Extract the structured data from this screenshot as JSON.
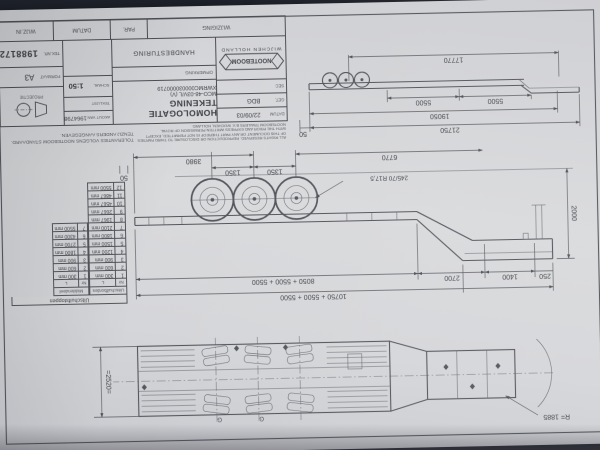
{
  "titleblock": {
    "company": "NOOTEBOOM",
    "location": "WIJCHEN  HOLLAND",
    "title": "HOMOLOGATIE TEKENING",
    "subtitle": "MCO-48-03V/L (V) XWRMC000030000719",
    "labels": {
      "datum": "DATUM",
      "get": "GET.",
      "sec": "SEC",
      "opmerking": "OPMERKING",
      "handbesturing": "HANDBESTURING",
      "akout": "AKOUT VAN",
      "teklijst": "TEKLIJST",
      "schaal": "SCHAAL",
      "projectie": "PROJECTIE",
      "formaat": "FORMAAT",
      "teknr": "TEK.NR.",
      "wijziging": "WIJZIGING",
      "par": "PAR.",
      "wijzin": "WIJZ.IN"
    },
    "values": {
      "datum": "22/09/03",
      "get": "BDG",
      "akout": "1964798",
      "schaal": "1:50",
      "formaat": "A3",
      "teknr": "1988172"
    },
    "tolerances_line1": "TOLERANTIES VOLGENS NOOTEBOOM STANDAARD.",
    "tolerances_line2": "TENZIJ ANDERS AANGEGEVEN.",
    "disclaimer": "ALL RIGHTS RESERVED. REPRODUCTION OR DISCLOSURE TO THIRD PARTIES OF THIS DOCUMENT OR ANY PART THEREOF IS NOT PERMITTED, EXCEPT WITH THE PRIOR AND EXPRESS WRITTEN PERMISSION OF ROYAL NOOTEBOOM TRAILERS B.V. WIJCHEN, HOLLAND."
  },
  "overview": {
    "d17770": "17770",
    "d5500a": "5500",
    "d5500b": "5500",
    "d19050": "19050",
    "d21750": "21750",
    "d50": "50"
  },
  "side": {
    "sum_top": "10750 + 5500 + 5500",
    "sum_mid": "8050 + 5500 + 5500",
    "d250": "250",
    "d1400": "1400",
    "d2700": "2700",
    "d6770": "6770",
    "d3980": "3980",
    "d1350a": "1350",
    "d1350b": "1350",
    "d50": "50",
    "d2000": "2000",
    "tyre": "245/70 R17,5"
  },
  "plan": {
    "width": "=2520=",
    "radius": "R= 1885",
    "g1": "G",
    "g2": "G"
  },
  "stop_table": {
    "title": "Uitschuifstoppen",
    "sub1": "Uitschuifbordes",
    "sub2": "Middendeel",
    "col_nr": "Nr",
    "col_l": "L",
    "bordes_rows": [
      [
        "1",
        "300 mm"
      ],
      [
        "2",
        "600 mm"
      ],
      [
        "3",
        "900 mm"
      ],
      [
        "4",
        "1200 mm"
      ],
      [
        "5",
        "1500 mm"
      ],
      [
        "6",
        "1800 mm"
      ],
      [
        "7",
        "2100 mm"
      ],
      [
        "8",
        "1967 mm"
      ],
      [
        "9",
        "2667 mm"
      ],
      [
        "10",
        "4567 mm"
      ],
      [
        "11",
        "4867 mm"
      ],
      [
        "12",
        "5500 mm"
      ]
    ],
    "midden_rows": [
      [
        "1",
        "300 mm"
      ],
      [
        "2",
        "600 mm"
      ],
      [
        "3",
        "900 mm"
      ],
      [
        "4",
        "1800 mm"
      ],
      [
        "5",
        "2700 mm"
      ],
      [
        "6",
        "4300 mm"
      ],
      [
        "7",
        "5500 mm"
      ]
    ]
  }
}
